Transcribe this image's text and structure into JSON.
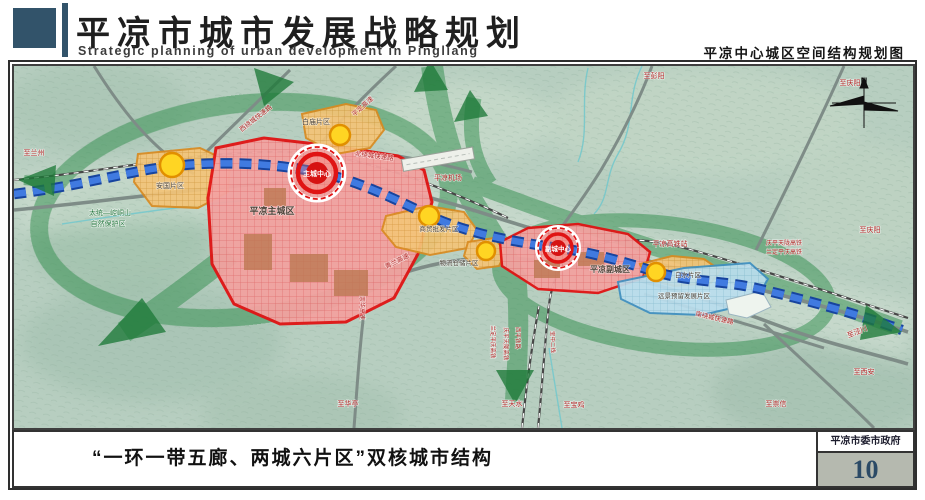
{
  "header": {
    "title": "平凉市城市发展战略规划",
    "subtitle": "Strategic planning of urban development in Pingliang",
    "map_title": "平凉中心城区空间结构规划图"
  },
  "footer": {
    "caption": "“一环一带五廊、两城六片区”双核城市结构",
    "authority": "平凉市委市政府",
    "page_number": "10"
  },
  "colors": {
    "accent_red": "#e01414",
    "zone_orange": "#f3c478",
    "belt_blue": "#407ae0",
    "corridor_green": "#2f8c4b",
    "reserve_blue": "#badeee",
    "page_number_blue": "#2b4a66"
  },
  "map": {
    "labels": [
      {
        "name": "label-zone-anguo",
        "text": "安国片区",
        "x": 168,
        "y": 186,
        "c": "zone",
        "s": 7
      },
      {
        "name": "label-zone-main-city",
        "text": "平凉主城区",
        "x": 270,
        "y": 212,
        "c": "zone bold",
        "s": 9
      },
      {
        "name": "label-main-center",
        "text": "主城中心",
        "x": 315,
        "y": 174,
        "c": "white bold",
        "s": 7
      },
      {
        "name": "label-zone-baimiao",
        "text": "白庙片区",
        "x": 314,
        "y": 122,
        "c": "zone",
        "s": 7
      },
      {
        "name": "label-zone-shangmao",
        "text": "商贸批发片区",
        "x": 437,
        "y": 229,
        "c": "zone",
        "s": 6.5
      },
      {
        "name": "label-zone-wuliu",
        "text": "物流仓储片区",
        "x": 457,
        "y": 263,
        "c": "zone",
        "s": 6.5
      },
      {
        "name": "label-zone-subcity",
        "text": "平凉副城区",
        "x": 608,
        "y": 270,
        "c": "zone bold",
        "s": 8
      },
      {
        "name": "label-sub-center",
        "text": "副城中心",
        "x": 556,
        "y": 249,
        "c": "white bold",
        "s": 6.5
      },
      {
        "name": "label-zone-baishui",
        "text": "白水片区",
        "x": 686,
        "y": 275,
        "c": "zone",
        "s": 6.5
      },
      {
        "name": "label-zone-reserve",
        "text": "远景预留发展片区",
        "x": 682,
        "y": 296,
        "c": "zone",
        "s": 6.5
      },
      {
        "name": "label-nature-reserve-1",
        "text": "太统—崆峒山",
        "x": 108,
        "y": 213,
        "c": "green",
        "s": 7
      },
      {
        "name": "label-nature-reserve-2",
        "text": "自然保护区",
        "x": 106,
        "y": 224,
        "c": "green",
        "s": 7
      },
      {
        "name": "label-airport",
        "text": "平凉机场",
        "x": 446,
        "y": 178,
        "c": "red",
        "s": 7
      },
      {
        "name": "label-to-lanzhou",
        "text": "至兰州",
        "x": 32,
        "y": 153,
        "c": "red",
        "s": 7
      },
      {
        "name": "label-west-ring-road",
        "text": "西绕城快速路",
        "x": 255,
        "y": 118,
        "c": "red",
        "s": 6.5,
        "r": -38
      },
      {
        "name": "label-pingding-expressway",
        "text": "平定高速",
        "x": 362,
        "y": 106,
        "c": "red",
        "s": 6.5,
        "r": -42
      },
      {
        "name": "label-north-ring-road",
        "text": "北绕城快速路",
        "x": 372,
        "y": 156,
        "c": "red",
        "s": 6.5,
        "r": 7
      },
      {
        "name": "label-to-pengyang",
        "text": "至彭阳",
        "x": 652,
        "y": 76,
        "c": "red",
        "s": 7
      },
      {
        "name": "label-to-qingyang-top",
        "text": "至庆阳",
        "x": 848,
        "y": 83,
        "c": "red",
        "s": 7
      },
      {
        "name": "label-qinglan-expressway",
        "text": "青兰高速",
        "x": 396,
        "y": 261,
        "c": "red",
        "s": 6.5,
        "r": -27
      },
      {
        "name": "label-hsr-station",
        "text": "平凉高铁站",
        "x": 668,
        "y": 244,
        "c": "red",
        "s": 7
      },
      {
        "name": "label-hsr-line-1",
        "text": "庆平天陇高铁",
        "x": 782,
        "y": 243,
        "c": "red",
        "s": 6
      },
      {
        "name": "label-hsr-line-2",
        "text": "兰定平庆高铁",
        "x": 782,
        "y": 252,
        "c": "red",
        "s": 6
      },
      {
        "name": "label-to-qingyang-right",
        "text": "至庆阳",
        "x": 868,
        "y": 230,
        "c": "red",
        "s": 7
      },
      {
        "name": "label-south-ring-road",
        "text": "南绕城快速路",
        "x": 712,
        "y": 318,
        "c": "red",
        "s": 6.5,
        "r": 13
      },
      {
        "name": "label-to-jingchuan",
        "text": "至泾川",
        "x": 856,
        "y": 332,
        "c": "red",
        "s": 7,
        "r": -22
      },
      {
        "name": "label-to-xian",
        "text": "至西安",
        "x": 862,
        "y": 372,
        "c": "red",
        "s": 7
      },
      {
        "name": "label-to-chongxin",
        "text": "至崇信",
        "x": 774,
        "y": 404,
        "c": "red",
        "s": 7
      },
      {
        "name": "label-to-huating",
        "text": "至华亭",
        "x": 346,
        "y": 404,
        "c": "red",
        "s": 7
      },
      {
        "name": "label-to-tianshui",
        "text": "至天水",
        "x": 510,
        "y": 404,
        "c": "red",
        "s": 7
      },
      {
        "name": "label-to-baoji",
        "text": "至宝鸡",
        "x": 572,
        "y": 405,
        "c": "red",
        "s": 7
      },
      {
        "name": "label-chonghua-expressway",
        "text": "崇华高速",
        "x": 358,
        "y": 306,
        "c": "red",
        "s": 6,
        "r": 90
      },
      {
        "name": "label-rail-landingpingqing",
        "text": "兰定平庆高铁",
        "x": 489,
        "y": 340,
        "c": "red",
        "s": 5.5,
        "r": 90
      },
      {
        "name": "label-rail-qingpingtianlong",
        "text": "庆平天陇高铁",
        "x": 502,
        "y": 342,
        "c": "red",
        "s": 5.5,
        "r": 90
      },
      {
        "name": "label-rail-xiping",
        "text": "西平铁路",
        "x": 514,
        "y": 336,
        "c": "red",
        "s": 5.5,
        "r": 90
      },
      {
        "name": "label-rail-baozhong",
        "text": "宝中二线",
        "x": 549,
        "y": 340,
        "c": "red",
        "s": 5.5,
        "r": 88
      },
      {
        "name": "label-compass-n",
        "text": "N",
        "x": 862,
        "y": 82,
        "c": "dark bold",
        "s": 9
      }
    ]
  }
}
